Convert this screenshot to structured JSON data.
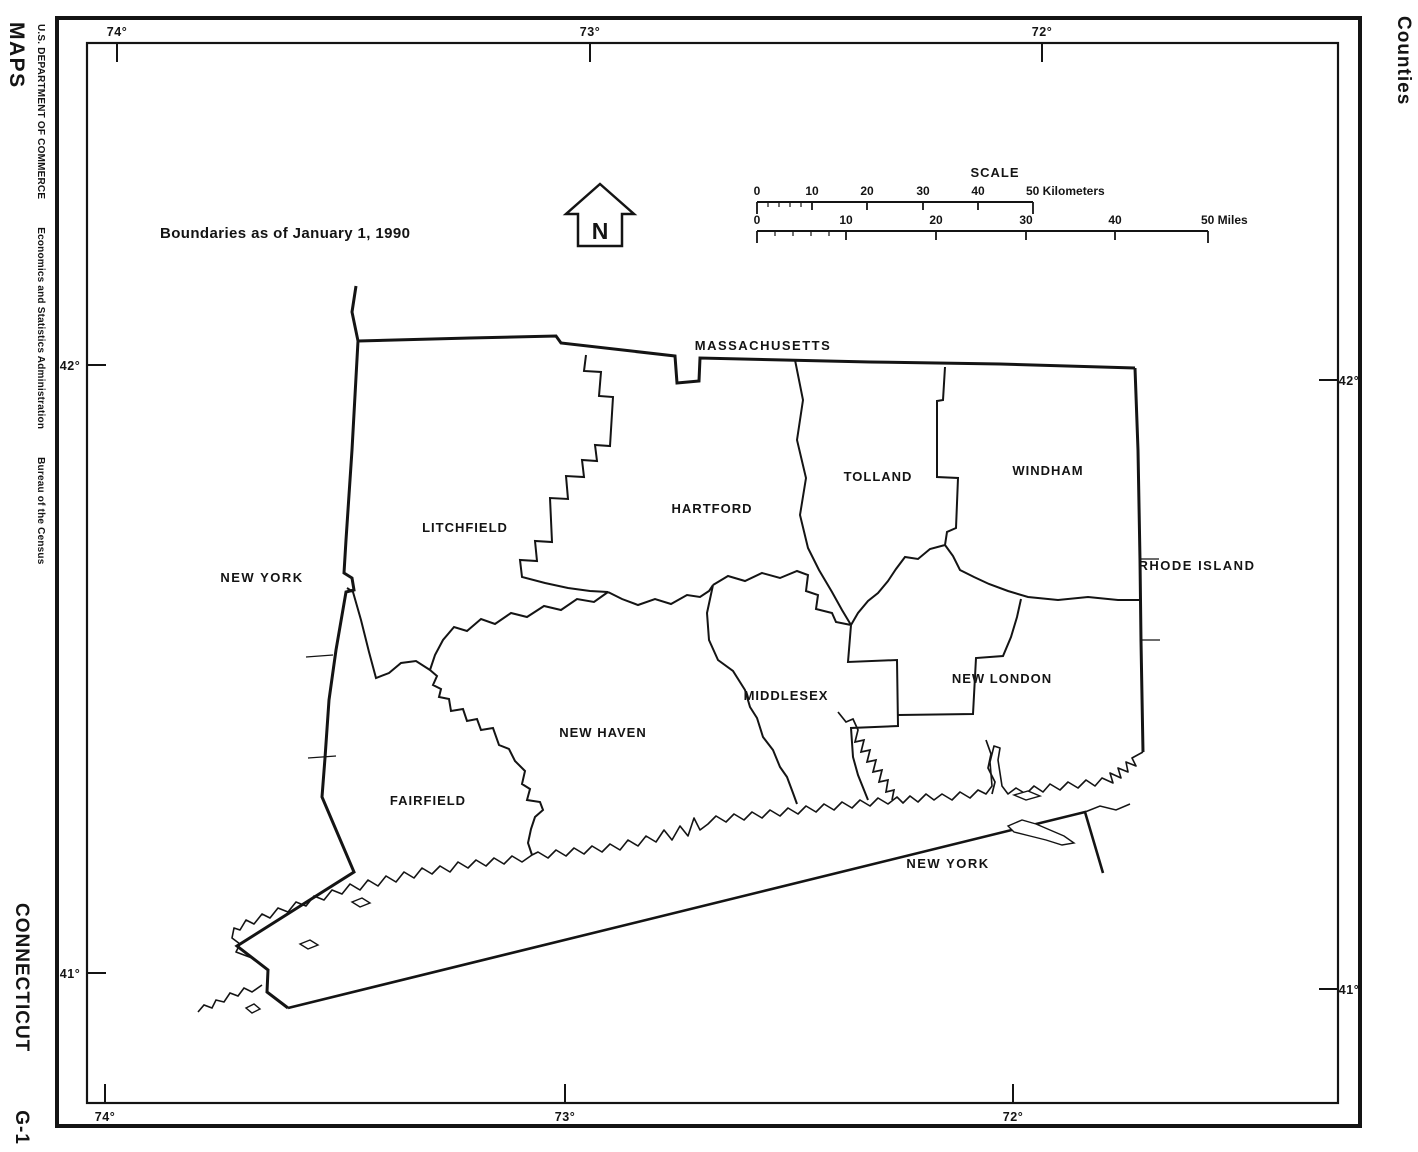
{
  "margins": {
    "series": "MAPS",
    "department": "U.S. DEPARTMENT OF COMMERCE",
    "administration": "Economics and Statistics Administration",
    "bureau": "Bureau of the Census",
    "sheet_title": "Counties",
    "state_name": "CONNECTICUT",
    "sheet_code": "G-1"
  },
  "map": {
    "note": "Boundaries as of January 1, 1990",
    "north_arrow": "N",
    "neighbors": {
      "massachusetts": "MASSACHUSETTS",
      "new_york_west": "NEW YORK",
      "new_york_sound": "NEW YORK",
      "rhode_island": "RHODE ISLAND"
    },
    "counties": {
      "litchfield": "LITCHFIELD",
      "hartford": "HARTFORD",
      "tolland": "TOLLAND",
      "windham": "WINDHAM",
      "new_haven": "NEW HAVEN",
      "middlesex": "MIDDLESEX",
      "new_london": "NEW LONDON",
      "fairfield": "FAIRFIELD"
    },
    "graticule": {
      "lon_74": "74°",
      "lon_73": "73°",
      "lon_72": "72°",
      "lat_42": "42°",
      "lat_41": "41°"
    }
  },
  "scale": {
    "title": "SCALE",
    "km": {
      "t0": "0",
      "t10": "10",
      "t20": "20",
      "t30": "30",
      "t40": "40",
      "t50": "50 Kilometers"
    },
    "mi": {
      "t0": "0",
      "t10": "10",
      "t20": "20",
      "t30": "30",
      "t40": "40",
      "t50": "50 Miles"
    }
  },
  "colors": {
    "ink": "#141414",
    "paper": "#ffffff"
  }
}
